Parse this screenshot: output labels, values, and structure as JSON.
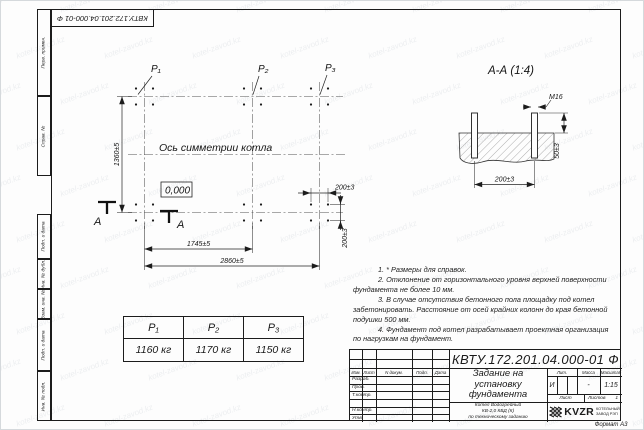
{
  "watermark": {
    "text": "kotel-zavod.kz"
  },
  "frame": {
    "top_stamp": "КВТУ.172.201.04.000-01 Ф",
    "side_labels": [
      "Перв. примен.",
      "Справ. №",
      "Подп. и дата",
      "Инв. № дубл.",
      "Взам. инв. №",
      "Подп. и дата",
      "Инв. № подл."
    ],
    "format_label": "Формат А3"
  },
  "plan": {
    "p_labels": [
      "Р₁",
      "Р₂",
      "Р₃"
    ],
    "axis_label": "Ось симметрии котла",
    "elevation": "0,000",
    "dim_height": "1360±5",
    "dim_span_1": "1745±5",
    "dim_span_2": "2860±5",
    "dim_bolt_h": "200±3",
    "dim_bolt_v": "200±3",
    "section_letter_1": "А",
    "section_letter_2": "А"
  },
  "section": {
    "title": "А-А (1:4)",
    "bolt_thread": "М16",
    "dim_protrusion": "50±3",
    "dim_bolt_spacing": "200±3"
  },
  "notes": {
    "lines": [
      "1. * Размеры для справок.",
      "2. Отклонение от горизонтального уровня верхней поверхности",
      "фундамента не более 10 мм.",
      "3. В случае отсутствия бетонного пола площадку под котел",
      "забетонировать. Расстояние от осей крайних колонн до края бетонной",
      "подушки 500 мм.",
      "4. Фундамент под котел разрабатывает проектная организация",
      "по нагрузкам на фундамент."
    ]
  },
  "loads_table": {
    "headers": [
      "Р₁",
      "Р₂",
      "Р₃"
    ],
    "values": [
      "1160 кг",
      "1170 кг",
      "1150 кг"
    ]
  },
  "title_block": {
    "doc_number": "КВТУ.172.201.04.000-01 Ф",
    "header_cols": [
      "Изм.",
      "Лист",
      "N докум.",
      "Подп.",
      "Дата"
    ],
    "row_labels": [
      "Разраб.",
      "Пров.",
      "Т.контр.",
      "Н.контр.",
      "Утв."
    ],
    "title_lines": [
      "Задание на",
      "установку",
      "фундамента"
    ],
    "subtitle_lines": [
      "Котел Водогрейный",
      "КВ-2,0 КБД (К)",
      "по техническому заданию"
    ],
    "lit_header": "Лит.",
    "mass_header": "Масса",
    "scale_header": "Масштаб",
    "lit_value": "И",
    "mass_value": "-",
    "scale_value": "1:15",
    "sheet_label": "Лист",
    "sheets_label": "Листов",
    "sheets_value": "1",
    "company_abbr": "KVZR",
    "company_line1": "КОТЕЛЬНЫЙ",
    "company_line2": "ЗАВОД РЭП"
  }
}
